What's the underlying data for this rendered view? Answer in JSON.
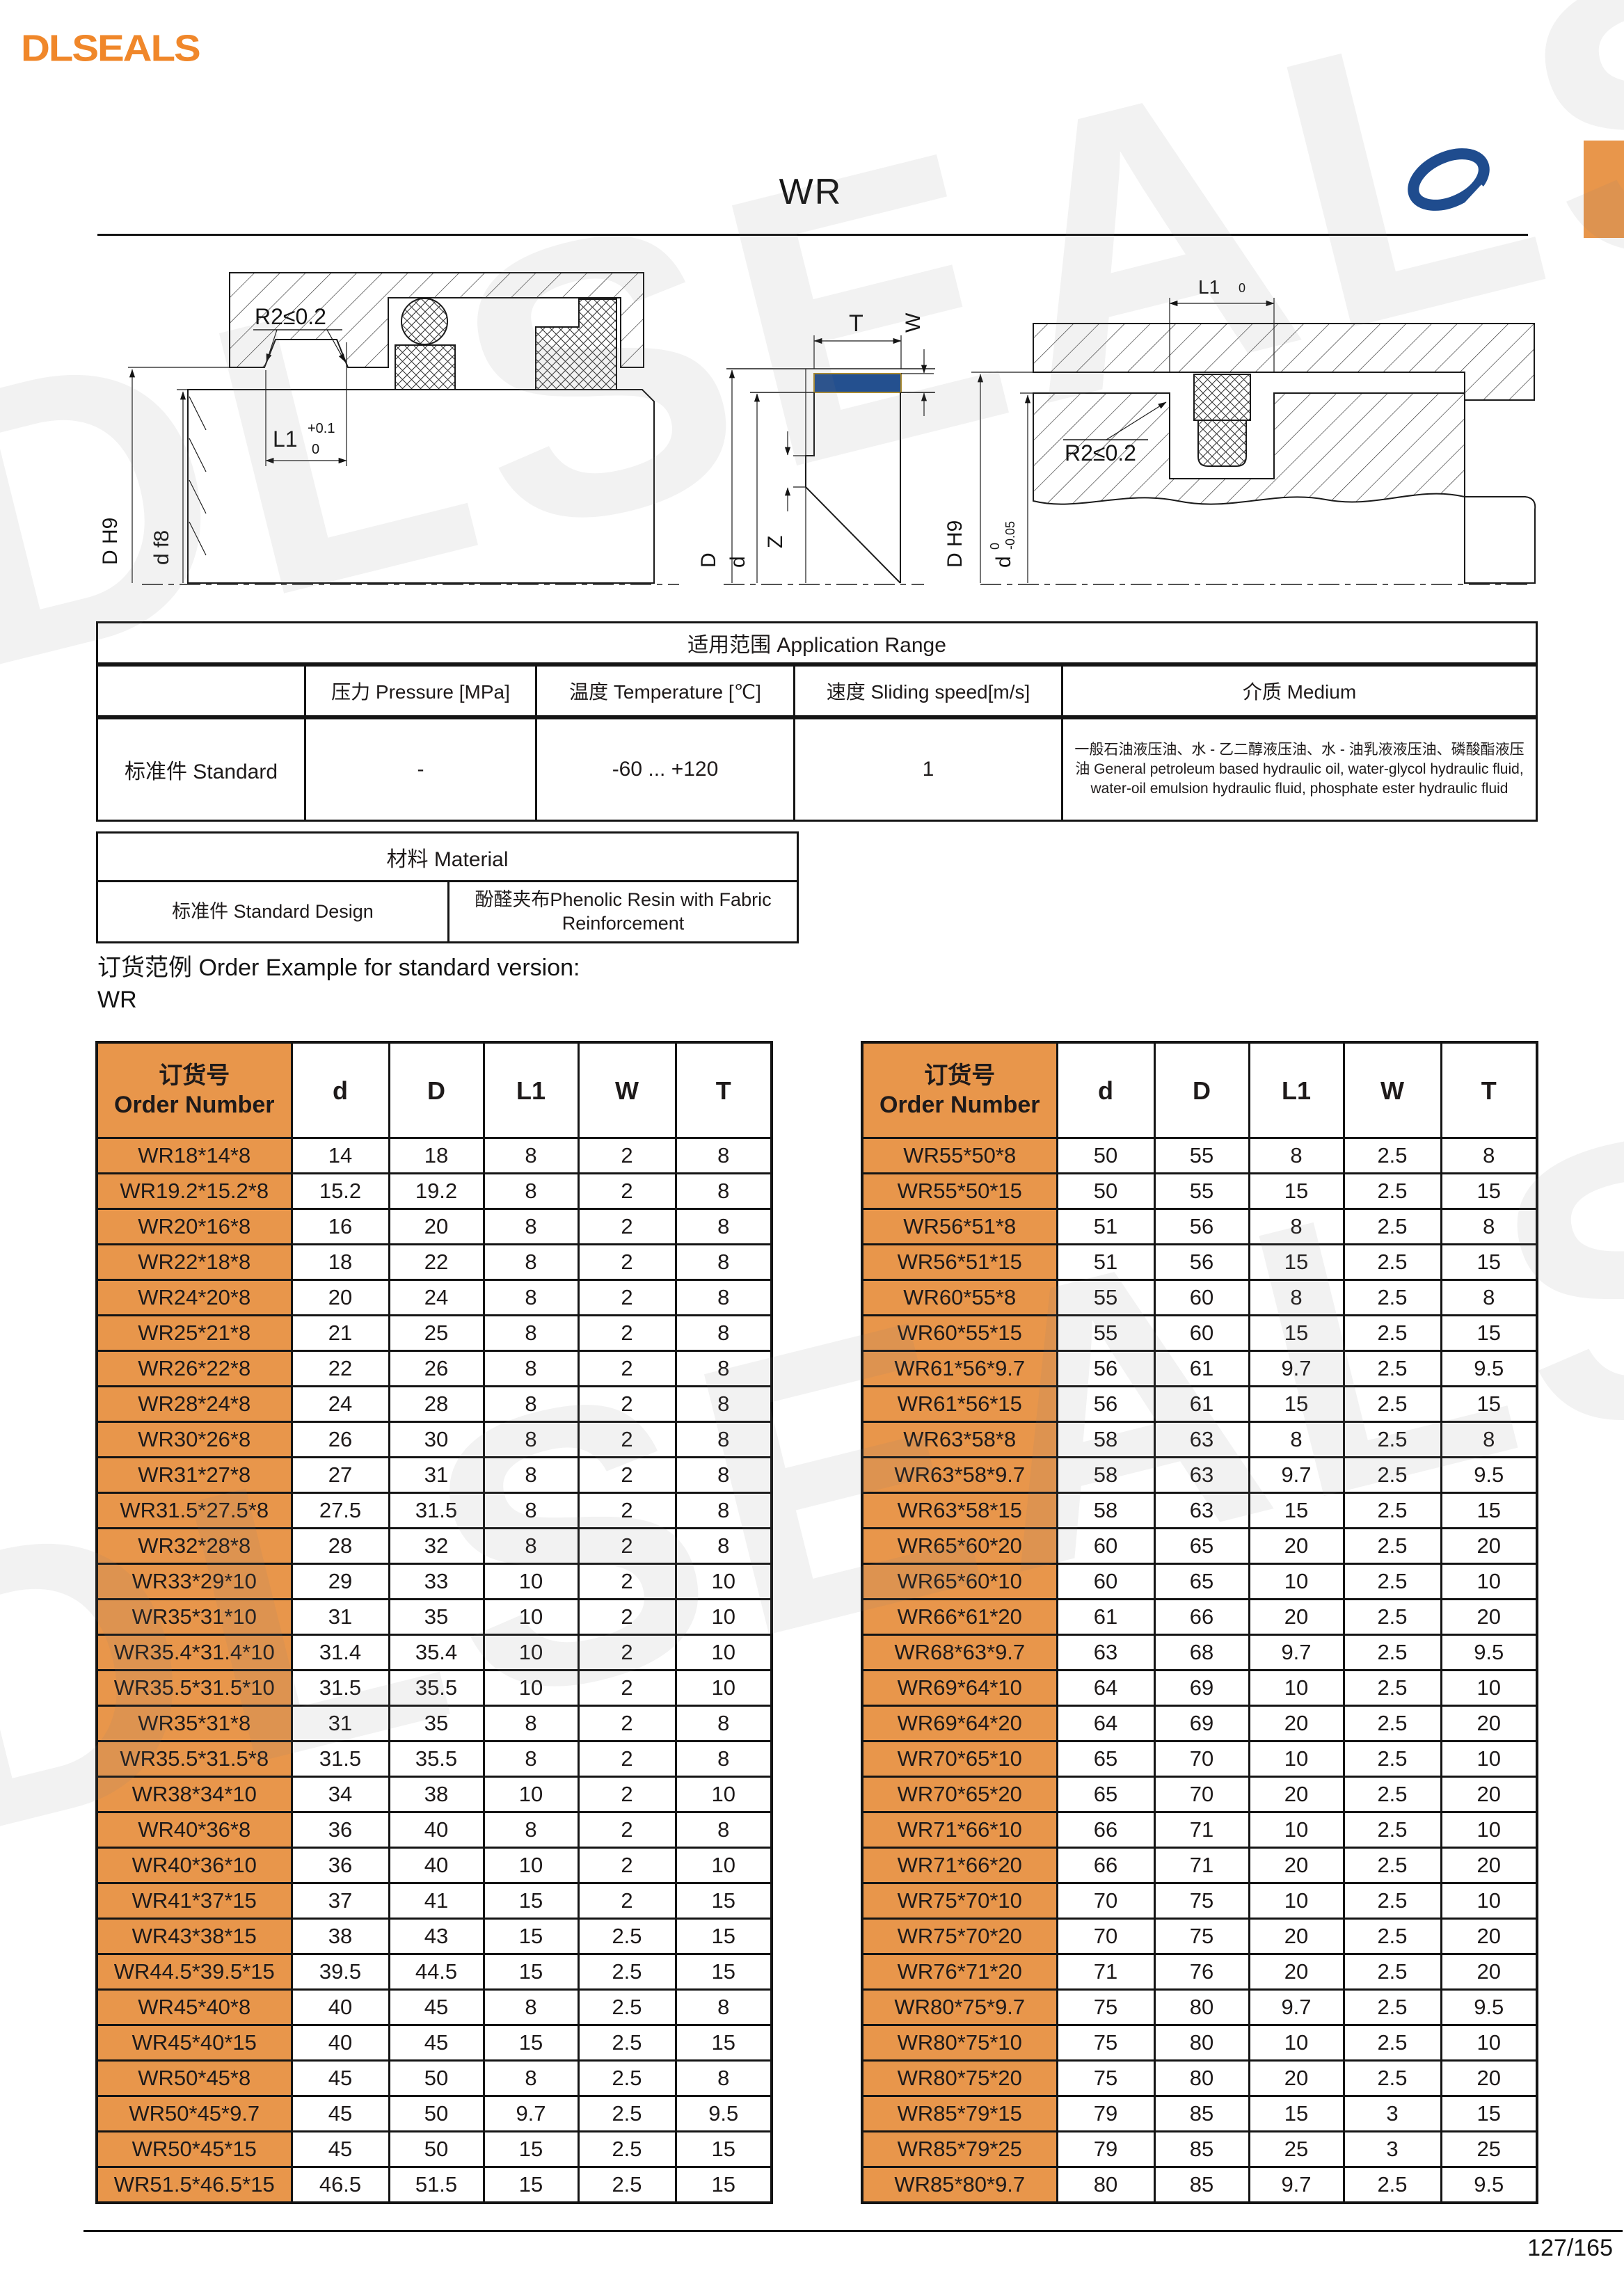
{
  "header": {
    "logo": "DLSEALS",
    "title": "WR"
  },
  "colors": {
    "brand_orange": "#F0872A",
    "table_orange": "#E8964B",
    "seal_blue": "#24508F",
    "line_black": "#141414"
  },
  "watermark": "DLSEALS",
  "drawings": {
    "left": {
      "r2_label": "R2≤0.2",
      "l1_label": "L1",
      "l1_tol_upper": "+0.1",
      "l1_tol_lower": "0",
      "bore_dim": "D H9",
      "shaft_dim": "d f8"
    },
    "middle": {
      "t_label": "T",
      "w_label": "W",
      "z_label": "Z",
      "outer_dim": "D",
      "inner_dim": "d"
    },
    "right": {
      "l1_label": "L1",
      "l1_tol": "0",
      "r2_label": "R2≤0.2",
      "bore_dim": "D H9",
      "shaft_dim": "d",
      "shaft_tol_upper": "0",
      "shaft_tol_lower": "-0.05"
    }
  },
  "application_range": {
    "title": "适用范围 Application Range",
    "columns": [
      "压力 Pressure [MPa]",
      "温度 Temperature [℃]",
      "速度 Sliding speed[m/s]",
      "介质 Medium"
    ],
    "row_label": "标准件 Standard",
    "pressure": "-",
    "temperature": "-60 ... +120",
    "sliding_speed": "1",
    "medium": "一般石油液压油、水 - 乙二醇液压油、水 - 油乳液液压油、磷酸酯液压油 General petroleum based hydraulic oil, water-glycol hydraulic fluid, water-oil emulsion hydraulic fluid, phosphate ester hydraulic fluid"
  },
  "material": {
    "title": "材料 Material",
    "row_label": "标准件 Standard Design",
    "value": "酚醛夹布Phenolic Resin with Fabric Reinforcement"
  },
  "order_example": {
    "line1": "订货范例 Order Example for standard version:",
    "line2": "WR"
  },
  "size_tables": {
    "order_header": "订货号\nOrder Number",
    "columns": [
      "d",
      "D",
      "L1",
      "W",
      "T"
    ],
    "left_rows": [
      [
        "WR18*14*8",
        "14",
        "18",
        "8",
        "2",
        "8"
      ],
      [
        "WR19.2*15.2*8",
        "15.2",
        "19.2",
        "8",
        "2",
        "8"
      ],
      [
        "WR20*16*8",
        "16",
        "20",
        "8",
        "2",
        "8"
      ],
      [
        "WR22*18*8",
        "18",
        "22",
        "8",
        "2",
        "8"
      ],
      [
        "WR24*20*8",
        "20",
        "24",
        "8",
        "2",
        "8"
      ],
      [
        "WR25*21*8",
        "21",
        "25",
        "8",
        "2",
        "8"
      ],
      [
        "WR26*22*8",
        "22",
        "26",
        "8",
        "2",
        "8"
      ],
      [
        "WR28*24*8",
        "24",
        "28",
        "8",
        "2",
        "8"
      ],
      [
        "WR30*26*8",
        "26",
        "30",
        "8",
        "2",
        "8"
      ],
      [
        "WR31*27*8",
        "27",
        "31",
        "8",
        "2",
        "8"
      ],
      [
        "WR31.5*27.5*8",
        "27.5",
        "31.5",
        "8",
        "2",
        "8"
      ],
      [
        "WR32*28*8",
        "28",
        "32",
        "8",
        "2",
        "8"
      ],
      [
        "WR33*29*10",
        "29",
        "33",
        "10",
        "2",
        "10"
      ],
      [
        "WR35*31*10",
        "31",
        "35",
        "10",
        "2",
        "10"
      ],
      [
        "WR35.4*31.4*10",
        "31.4",
        "35.4",
        "10",
        "2",
        "10"
      ],
      [
        "WR35.5*31.5*10",
        "31.5",
        "35.5",
        "10",
        "2",
        "10"
      ],
      [
        "WR35*31*8",
        "31",
        "35",
        "8",
        "2",
        "8"
      ],
      [
        "WR35.5*31.5*8",
        "31.5",
        "35.5",
        "8",
        "2",
        "8"
      ],
      [
        "WR38*34*10",
        "34",
        "38",
        "10",
        "2",
        "10"
      ],
      [
        "WR40*36*8",
        "36",
        "40",
        "8",
        "2",
        "8"
      ],
      [
        "WR40*36*10",
        "36",
        "40",
        "10",
        "2",
        "10"
      ],
      [
        "WR41*37*15",
        "37",
        "41",
        "15",
        "2",
        "15"
      ],
      [
        "WR43*38*15",
        "38",
        "43",
        "15",
        "2.5",
        "15"
      ],
      [
        "WR44.5*39.5*15",
        "39.5",
        "44.5",
        "15",
        "2.5",
        "15"
      ],
      [
        "WR45*40*8",
        "40",
        "45",
        "8",
        "2.5",
        "8"
      ],
      [
        "WR45*40*15",
        "40",
        "45",
        "15",
        "2.5",
        "15"
      ],
      [
        "WR50*45*8",
        "45",
        "50",
        "8",
        "2.5",
        "8"
      ],
      [
        "WR50*45*9.7",
        "45",
        "50",
        "9.7",
        "2.5",
        "9.5"
      ],
      [
        "WR50*45*15",
        "45",
        "50",
        "15",
        "2.5",
        "15"
      ],
      [
        "WR51.5*46.5*15",
        "46.5",
        "51.5",
        "15",
        "2.5",
        "15"
      ]
    ],
    "right_rows": [
      [
        "WR55*50*8",
        "50",
        "55",
        "8",
        "2.5",
        "8"
      ],
      [
        "WR55*50*15",
        "50",
        "55",
        "15",
        "2.5",
        "15"
      ],
      [
        "WR56*51*8",
        "51",
        "56",
        "8",
        "2.5",
        "8"
      ],
      [
        "WR56*51*15",
        "51",
        "56",
        "15",
        "2.5",
        "15"
      ],
      [
        "WR60*55*8",
        "55",
        "60",
        "8",
        "2.5",
        "8"
      ],
      [
        "WR60*55*15",
        "55",
        "60",
        "15",
        "2.5",
        "15"
      ],
      [
        "WR61*56*9.7",
        "56",
        "61",
        "9.7",
        "2.5",
        "9.5"
      ],
      [
        "WR61*56*15",
        "56",
        "61",
        "15",
        "2.5",
        "15"
      ],
      [
        "WR63*58*8",
        "58",
        "63",
        "8",
        "2.5",
        "8"
      ],
      [
        "WR63*58*9.7",
        "58",
        "63",
        "9.7",
        "2.5",
        "9.5"
      ],
      [
        "WR63*58*15",
        "58",
        "63",
        "15",
        "2.5",
        "15"
      ],
      [
        "WR65*60*20",
        "60",
        "65",
        "20",
        "2.5",
        "20"
      ],
      [
        "WR65*60*10",
        "60",
        "65",
        "10",
        "2.5",
        "10"
      ],
      [
        "WR66*61*20",
        "61",
        "66",
        "20",
        "2.5",
        "20"
      ],
      [
        "WR68*63*9.7",
        "63",
        "68",
        "9.7",
        "2.5",
        "9.5"
      ],
      [
        "WR69*64*10",
        "64",
        "69",
        "10",
        "2.5",
        "10"
      ],
      [
        "WR69*64*20",
        "64",
        "69",
        "20",
        "2.5",
        "20"
      ],
      [
        "WR70*65*10",
        "65",
        "70",
        "10",
        "2.5",
        "10"
      ],
      [
        "WR70*65*20",
        "65",
        "70",
        "20",
        "2.5",
        "20"
      ],
      [
        "WR71*66*10",
        "66",
        "71",
        "10",
        "2.5",
        "10"
      ],
      [
        "WR71*66*20",
        "66",
        "71",
        "20",
        "2.5",
        "20"
      ],
      [
        "WR75*70*10",
        "70",
        "75",
        "10",
        "2.5",
        "10"
      ],
      [
        "WR75*70*20",
        "70",
        "75",
        "20",
        "2.5",
        "20"
      ],
      [
        "WR76*71*20",
        "71",
        "76",
        "20",
        "2.5",
        "20"
      ],
      [
        "WR80*75*9.7",
        "75",
        "80",
        "9.7",
        "2.5",
        "9.5"
      ],
      [
        "WR80*75*10",
        "75",
        "80",
        "10",
        "2.5",
        "10"
      ],
      [
        "WR80*75*20",
        "75",
        "80",
        "20",
        "2.5",
        "20"
      ],
      [
        "WR85*79*15",
        "79",
        "85",
        "15",
        "3",
        "15"
      ],
      [
        "WR85*79*25",
        "79",
        "85",
        "25",
        "3",
        "25"
      ],
      [
        "WR85*80*9.7",
        "80",
        "85",
        "9.7",
        "2.5",
        "9.5"
      ]
    ]
  },
  "footer": {
    "page_number": "127/165"
  }
}
